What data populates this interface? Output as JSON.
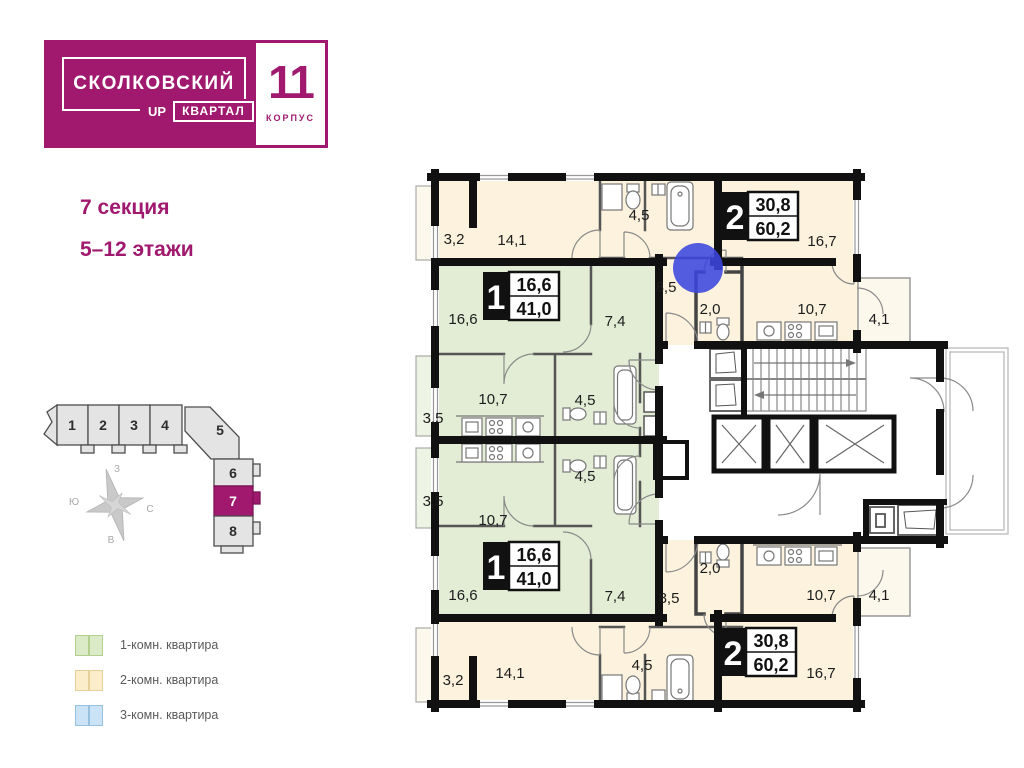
{
  "logo": {
    "brand": "СКОЛКОВСКИЙ",
    "quarter_prefix": "UP",
    "quarter": "КВАРТАЛ",
    "building_number": "11",
    "building_label": "КОРПУС",
    "brand_color": "#a0196e"
  },
  "section_info": {
    "section": "7 секция",
    "floors": "5–12 этажи"
  },
  "minimap": {
    "sections": [
      "1",
      "2",
      "3",
      "4",
      "5",
      "6",
      "7",
      "8"
    ],
    "active_section": "7",
    "active_color": "#a0196e"
  },
  "compass": {
    "top": "З",
    "left": "Ю",
    "right": "С",
    "bottom": "В"
  },
  "legend": {
    "items": [
      {
        "label": "1-комн. квартира",
        "color": "#dcebc7"
      },
      {
        "label": "2-комн. квартира",
        "color": "#fbecca"
      },
      {
        "label": "3-комн. квартира",
        "color": "#cbe3f6"
      }
    ]
  },
  "plan": {
    "marker_color": "#3b46de",
    "fill_one_room": "#e3edd5",
    "fill_two_room": "#fcf2dd",
    "apartments": [
      {
        "type": "2-комн. квартира",
        "position": "top",
        "badge": {
          "number": "2",
          "living_area": "30,8",
          "total_area": "60,2"
        },
        "rooms": [
          {
            "name": "balcony",
            "area": "3,2"
          },
          {
            "name": "room",
            "area": "14,1"
          },
          {
            "name": "bathroom",
            "area": "4,5"
          },
          {
            "name": "hall",
            "area": "8,5"
          },
          {
            "name": "wc",
            "area": "2,0"
          },
          {
            "name": "living-room",
            "area": "16,7"
          },
          {
            "name": "kitchen",
            "area": "10,7"
          },
          {
            "name": "balcony",
            "area": "4,1"
          }
        ]
      },
      {
        "type": "1-комн. квартира",
        "position": "top",
        "badge": {
          "number": "1",
          "living_area": "16,6",
          "total_area": "41,0"
        },
        "rooms": [
          {
            "name": "living-room",
            "area": "16,6"
          },
          {
            "name": "hall",
            "area": "7,4"
          },
          {
            "name": "kitchen",
            "area": "10,7"
          },
          {
            "name": "bathroom",
            "area": "4,5"
          },
          {
            "name": "balcony",
            "area": "3,5"
          }
        ]
      },
      {
        "type": "1-комн. квартира",
        "position": "bottom",
        "badge": {
          "number": "1",
          "living_area": "16,6",
          "total_area": "41,0"
        },
        "rooms": [
          {
            "name": "living-room",
            "area": "16,6"
          },
          {
            "name": "hall",
            "area": "7,4"
          },
          {
            "name": "kitchen",
            "area": "10,7"
          },
          {
            "name": "bathroom",
            "area": "4,5"
          },
          {
            "name": "balcony",
            "area": "3,5"
          }
        ]
      },
      {
        "type": "2-комн. квартира",
        "position": "bottom",
        "badge": {
          "number": "2",
          "living_area": "30,8",
          "total_area": "60,2"
        },
        "rooms": [
          {
            "name": "balcony",
            "area": "3,2"
          },
          {
            "name": "room",
            "area": "14,1"
          },
          {
            "name": "bathroom",
            "area": "4,5"
          },
          {
            "name": "hall",
            "area": "8,5"
          },
          {
            "name": "wc",
            "area": "2,0"
          },
          {
            "name": "living-room",
            "area": "16,7"
          },
          {
            "name": "kitchen",
            "area": "10,7"
          },
          {
            "name": "balcony",
            "area": "4,1"
          }
        ]
      }
    ]
  }
}
